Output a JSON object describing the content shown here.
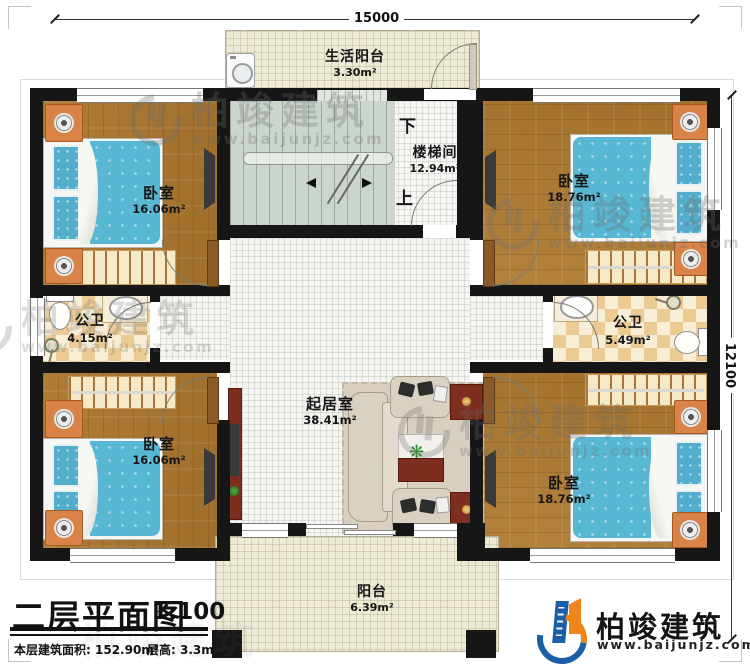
{
  "dimensions": {
    "width_mm": "15000",
    "depth_mm": "12100"
  },
  "rooms": {
    "life_balcony": {
      "name": "生活阳台",
      "area": "3.30m²"
    },
    "stairwell": {
      "name": "楼梯间",
      "area": "12.94m²",
      "down_label": "下",
      "up_label": "上"
    },
    "bedroom_tl": {
      "name": "卧室",
      "area": "16.06m²"
    },
    "bedroom_tr": {
      "name": "卧室",
      "area": "18.76m²"
    },
    "bathroom_left": {
      "name": "公卫",
      "area": "4.15m²"
    },
    "bathroom_right": {
      "name": "公卫",
      "area": "5.49m²"
    },
    "living_room": {
      "name": "起居室",
      "area": "38.41m²"
    },
    "bedroom_bl": {
      "name": "卧室",
      "area": "16.06m²"
    },
    "bedroom_br": {
      "name": "卧室",
      "area": "18.76m²"
    },
    "balcony": {
      "name": "阳台",
      "area": "6.39m²"
    }
  },
  "title_block": {
    "title": "二层平面图",
    "scale": "1:100",
    "area_label": "本层建筑面积:",
    "area_value": "152.90m²",
    "height_label": "层高:",
    "height_value": "3.3m"
  },
  "branding": {
    "company": "柏竣建筑",
    "website": "www.baijunjz.com"
  },
  "watermark": {
    "company": "柏竣建筑",
    "website": "www.baijunjz.com"
  },
  "icons": {
    "plant": "❋"
  },
  "colors": {
    "wall": "#161616",
    "wood_floor": "#a97a33",
    "tile": "#f5f5f2",
    "balcony": "#edead6",
    "stairs": "#ccd5cc",
    "checker_dark": "#ebca93",
    "checker_light": "#f8eed7",
    "bed": "#58b7d2",
    "nightstand": "#d98348",
    "cabinet": "#7d2e1e",
    "logo_blue": "#1a5fa8",
    "logo_orange": "#f08519"
  }
}
